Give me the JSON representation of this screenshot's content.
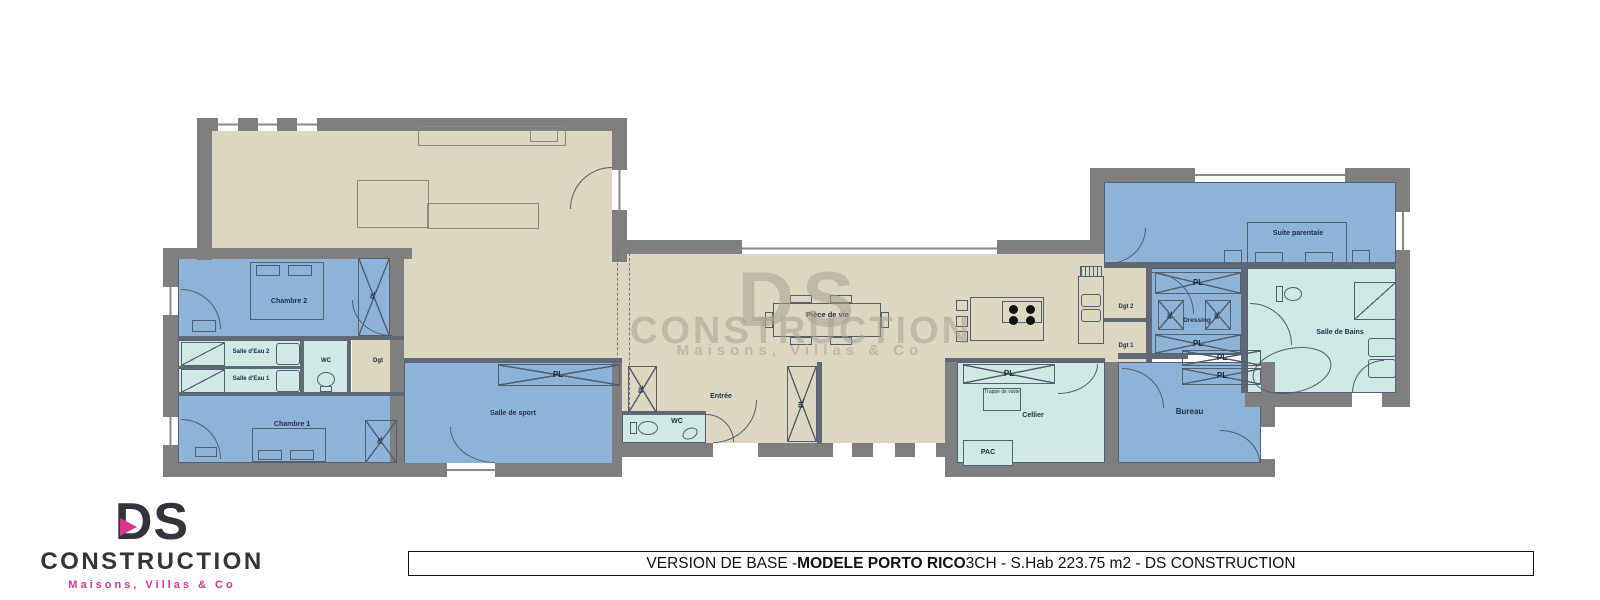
{
  "plan": {
    "rooms": {
      "piece_de_vie": "Pièce de vie",
      "chambre_2": "Chambre 2",
      "chambre_1": "Chambre 1",
      "salle_eau_2": "Salle d'Eau 2",
      "salle_eau_1": "Salle d'Eau 1",
      "wc_chambres": "WC",
      "degagement": "Dgt",
      "salle_de_sport": "Salle de sport",
      "entree": "Entrée",
      "wc_entree": "WC",
      "cellier": "Cellier",
      "pac": "PAC",
      "trappe_de_visite": "Trappe de visite",
      "bureau": "Bureau",
      "dgt_1": "Dgt 1",
      "dgt_2": "Dgt 2",
      "dressing": "Dressing",
      "suite_parentale": "Suite parentale",
      "salle_de_bains": "Salle de Bains"
    },
    "closet_label": "PL"
  },
  "watermark": {
    "monogram": "DS",
    "name": "CONSTRUCTION",
    "tagline": "Maisons, Villas & Co"
  },
  "logo": {
    "monogram": "DS",
    "name": "CONSTRUCTION",
    "tagline": "Maisons, Villas & Co"
  },
  "title_bar": {
    "prefix": "VERSION DE BASE - ",
    "model": "MODELE PORTO RICO",
    "suffix": " 3CH - S.Hab 223.75 m2 - DS CONSTRUCTION"
  },
  "colors": {
    "wall_gray": "#7f7f7f",
    "floor_beige": "#ddd7c1",
    "room_blue": "#8db3d8",
    "room_teal": "#cfe9e4",
    "brand_pink": "#d9368b",
    "ink_dark": "#21304a"
  }
}
